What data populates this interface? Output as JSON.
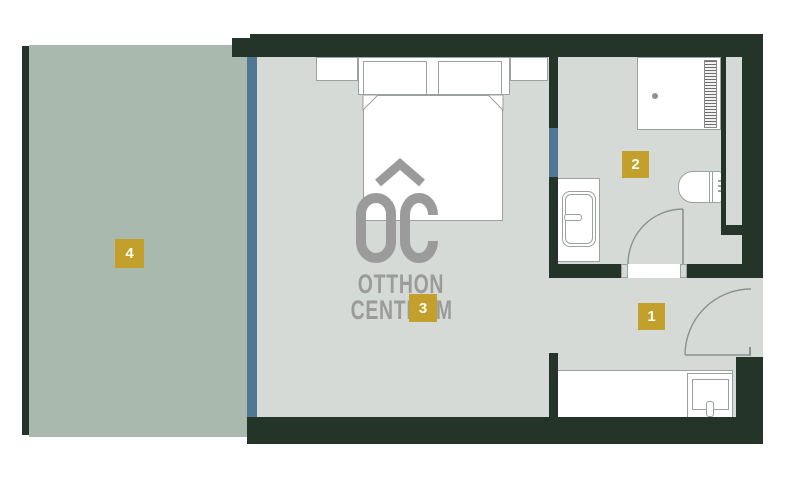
{
  "watermark": {
    "monogram": "OC",
    "line1": "OTTHON",
    "line2": "CENTRUM"
  },
  "rooms": [
    {
      "label": "1"
    },
    {
      "label": "2"
    },
    {
      "label": "3"
    },
    {
      "label": "4"
    }
  ],
  "colors": {
    "wall": "#243428",
    "floor": "#d5dad6",
    "terrace": "#aab9ae",
    "window": "#527795",
    "gold": "#c2a02b",
    "line": "#9aa19e",
    "door": "#8b918e",
    "mark": "#9b9b9b"
  }
}
